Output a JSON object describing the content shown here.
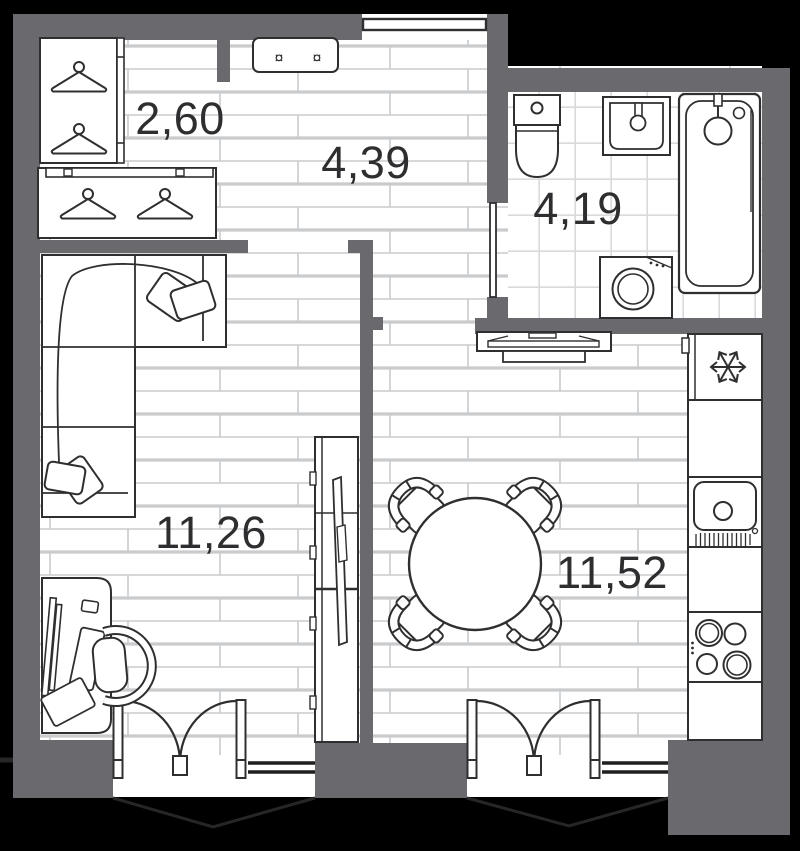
{
  "plan": {
    "rooms": [
      {
        "name": "wardrobe",
        "area_label": "2,60"
      },
      {
        "name": "hallway",
        "area_label": "4,39"
      },
      {
        "name": "bathroom",
        "area_label": "4,19"
      },
      {
        "name": "living-room",
        "area_label": "11,26"
      },
      {
        "name": "kitchen-dining",
        "area_label": "11,52"
      }
    ],
    "icons": {
      "fitting_glyph": "¤"
    },
    "colors": {
      "background": "#000000",
      "wall": "#6a6a6e",
      "floor": "#ffffff",
      "plank_line": "#c9cbcd",
      "tile_line": "#d8dadb",
      "outline": "#2f2f31",
      "balcony_line": "#262626",
      "label": "#2e2e30"
    }
  }
}
